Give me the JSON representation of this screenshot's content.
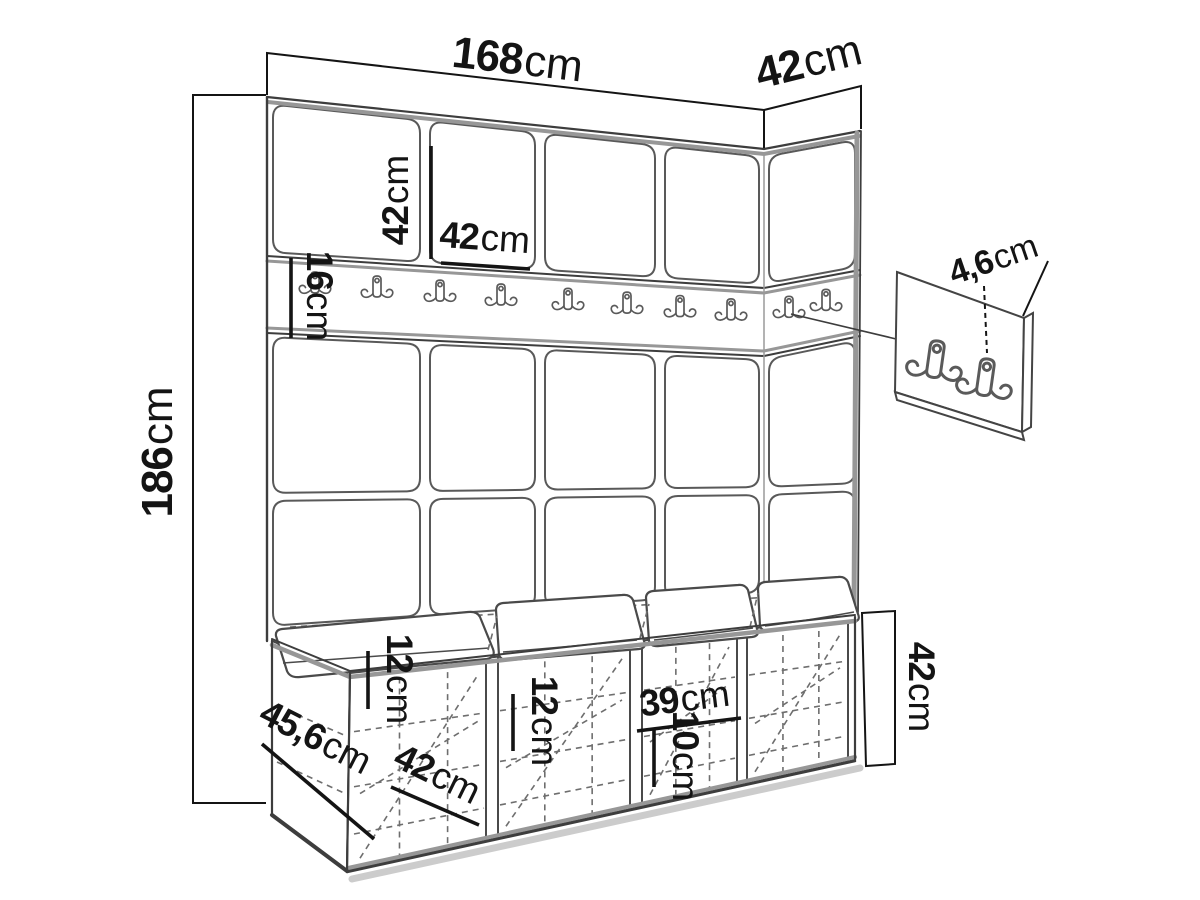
{
  "dimensions": {
    "total_width": {
      "value": "168",
      "unit": "cm"
    },
    "side_depth": {
      "value": "42",
      "unit": "cm"
    },
    "total_height": {
      "value": "186",
      "unit": "cm"
    },
    "panel_height": {
      "value": "42",
      "unit": "cm"
    },
    "panel_width": {
      "value": "42",
      "unit": "cm"
    },
    "rail_height": {
      "value": "16",
      "unit": "cm"
    },
    "hook_panel_depth": {
      "value": "4,6",
      "unit": "cm"
    },
    "bench_height": {
      "value": "42",
      "unit": "cm"
    },
    "bench_shelf_top": {
      "value": "12",
      "unit": "cm"
    },
    "bench_shelf_middle": {
      "value": "12",
      "unit": "cm"
    },
    "bench_inner_width": {
      "value": "39",
      "unit": "cm"
    },
    "bench_shelf_bottom": {
      "value": "10",
      "unit": "cm"
    },
    "bench_depth": {
      "value": "45,6",
      "unit": "cm"
    },
    "bench_compartment_width": {
      "value": "42",
      "unit": "cm"
    }
  },
  "icons": {
    "coat_hook": "double-coat-hook"
  },
  "colors": {
    "background": "#ffffff",
    "ink": "#141414",
    "line": "#3d3d3d",
    "soft_gray": "#979797",
    "dash": "#6e6e6e",
    "shadow": "#cccccc"
  }
}
